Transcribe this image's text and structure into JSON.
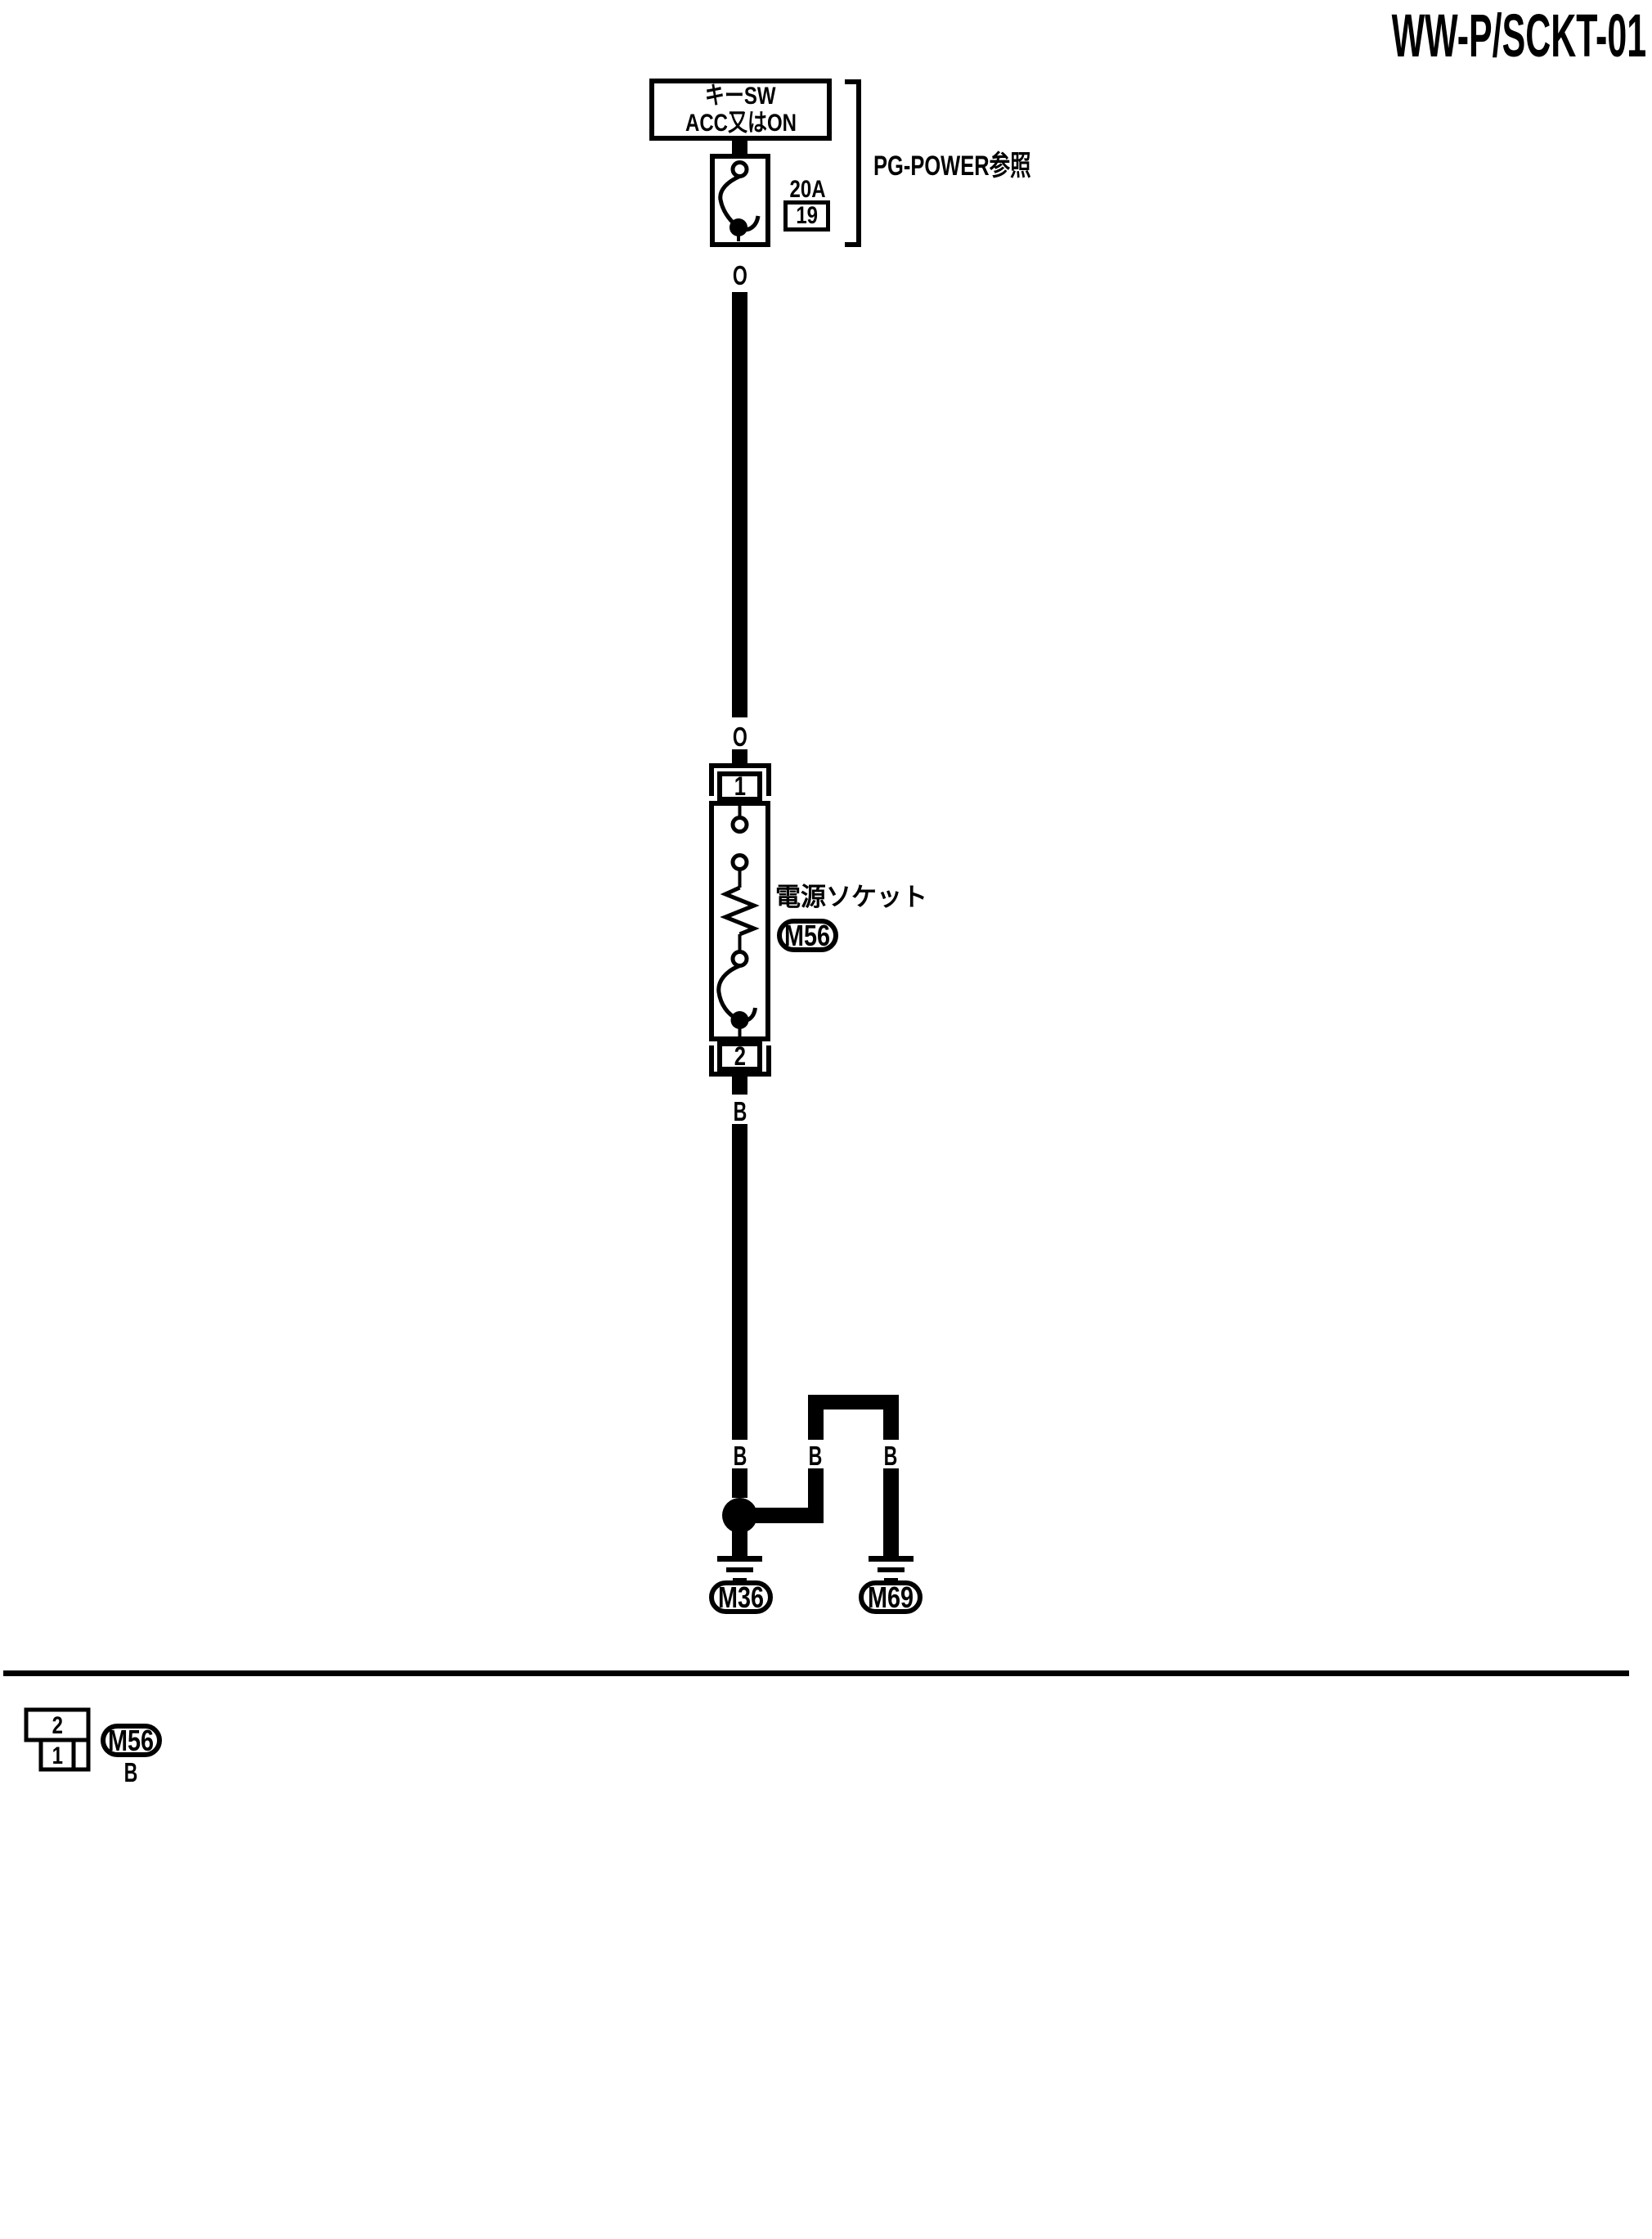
{
  "page": {
    "title": "WW-P/SCKT-01"
  },
  "power_source": {
    "source_line1": "キーSW",
    "source_line2": "ACC又はON",
    "fuse_rating": "20A",
    "fuse_number": "19",
    "reference": "PG-POWER参照"
  },
  "wire_colors": {
    "upper_o": "O",
    "mid_o": "O",
    "socket_b": "B",
    "branch_main_b": "B",
    "branch_mid_b": "B",
    "branch_right_b": "B"
  },
  "socket": {
    "label": "電源ソケット",
    "connector": "M56",
    "pin_top": "1",
    "pin_bottom": "2"
  },
  "grounds": {
    "left": "M36",
    "right": "M69"
  },
  "connector_detail": {
    "pin_upper": "2",
    "pin_lower": "1",
    "connector": "M56",
    "wire_color": "B"
  }
}
